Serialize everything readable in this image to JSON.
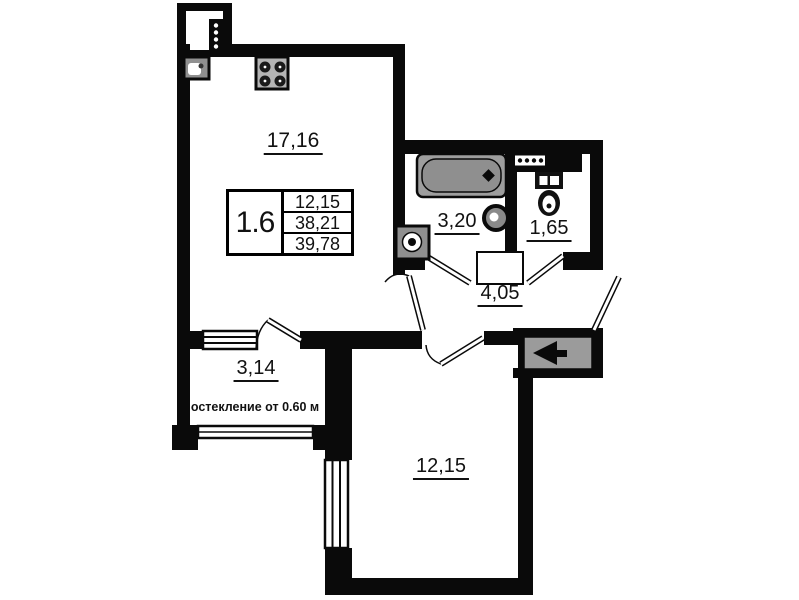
{
  "plan": {
    "colors": {
      "background": "#ffffff",
      "wall": "#0a0a0a",
      "fixture_gray": "#9e9e9e",
      "door_panel_gray": "#9b9b9b"
    },
    "unit_table": {
      "unit_label": "1.6",
      "rows": [
        "12,15",
        "38,21",
        "39,78"
      ]
    },
    "rooms": [
      {
        "name": "kitchen-living-room",
        "area": "17,16"
      },
      {
        "name": "bathroom",
        "area": "3,20"
      },
      {
        "name": "toilet",
        "area": "1,65"
      },
      {
        "name": "hallway",
        "area": "4,05"
      },
      {
        "name": "balcony",
        "area": "3,14"
      },
      {
        "name": "bedroom",
        "area": "12,15"
      }
    ],
    "notes": {
      "glazing": "остекление от 0.60 м"
    },
    "icons": [
      "kitchen-sink-icon",
      "stove-icon",
      "bathtub-icon",
      "washbasin-icon",
      "water-heater-icon",
      "toilet-icon",
      "vent-grille-icon",
      "entrance-door-arrow-icon",
      "window-glazing",
      "door-swing"
    ]
  }
}
